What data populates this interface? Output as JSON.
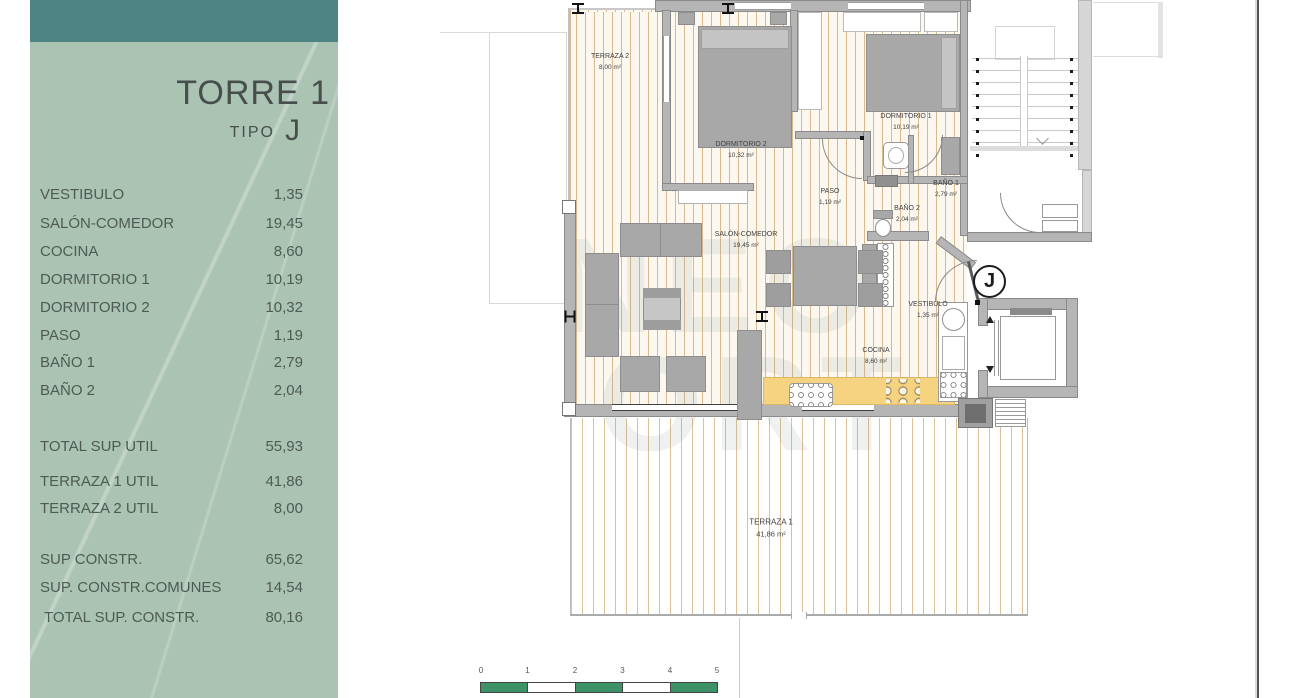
{
  "sidebar": {
    "title": "TORRE 1",
    "tipo_label": "TIPO",
    "tipo_value": "J",
    "rows": [
      {
        "label": "VESTIBULO",
        "value": "1,35"
      },
      {
        "label": "SALÓN-COMEDOR",
        "value": "19,45"
      },
      {
        "label": "COCINA",
        "value": "8,60"
      },
      {
        "label": "DORMITORIO 1",
        "value": "10,19"
      },
      {
        "label": "DORMITORIO 2",
        "value": "10,32"
      },
      {
        "label": "PASO",
        "value": "1,19"
      },
      {
        "label": "BAÑO 1",
        "value": "2,79"
      },
      {
        "label": "BAÑO 2",
        "value": "2,04"
      },
      {
        "label": "TOTAL SUP UTIL",
        "value": "55,93"
      },
      {
        "label": "TERRAZA 1 UTIL",
        "value": "41,86"
      },
      {
        "label": "TERRAZA 2 UTIL",
        "value": "8,00"
      },
      {
        "label": "SUP CONSTR.",
        "value": "65,62"
      },
      {
        "label": "SUP. CONSTR.COMUNES",
        "value": "14,54"
      },
      {
        "label": "TOTAL SUP. CONSTR.",
        "value": "80,16"
      }
    ]
  },
  "plan": {
    "unit_marker": "J",
    "watermark": {
      "line1": "NEO",
      "line2": "ORT"
    },
    "rooms": [
      {
        "name": "TERRAZA 2",
        "area": "8,00 m²"
      },
      {
        "name": "DORMITORIO 2",
        "area": "10,32 m²"
      },
      {
        "name": "DORMITORIO 1",
        "area": "10,19 m²"
      },
      {
        "name": "PASO",
        "area": "1,19 m²"
      },
      {
        "name": "BAÑO 1",
        "area": "2,79 m²"
      },
      {
        "name": "BAÑO 2",
        "area": "2,04 m²"
      },
      {
        "name": "SALÓN-COMEDOR",
        "area": "19,45 m²"
      },
      {
        "name": "VESTIBULO",
        "area": "1,35 m²"
      },
      {
        "name": "COCINA",
        "area": "8,60 m²"
      },
      {
        "name": "TERRAZA 1",
        "area": "41,86 m²"
      }
    ]
  },
  "scalebar": {
    "ticks": [
      "0",
      "1",
      "2",
      "3",
      "4",
      "5"
    ]
  }
}
